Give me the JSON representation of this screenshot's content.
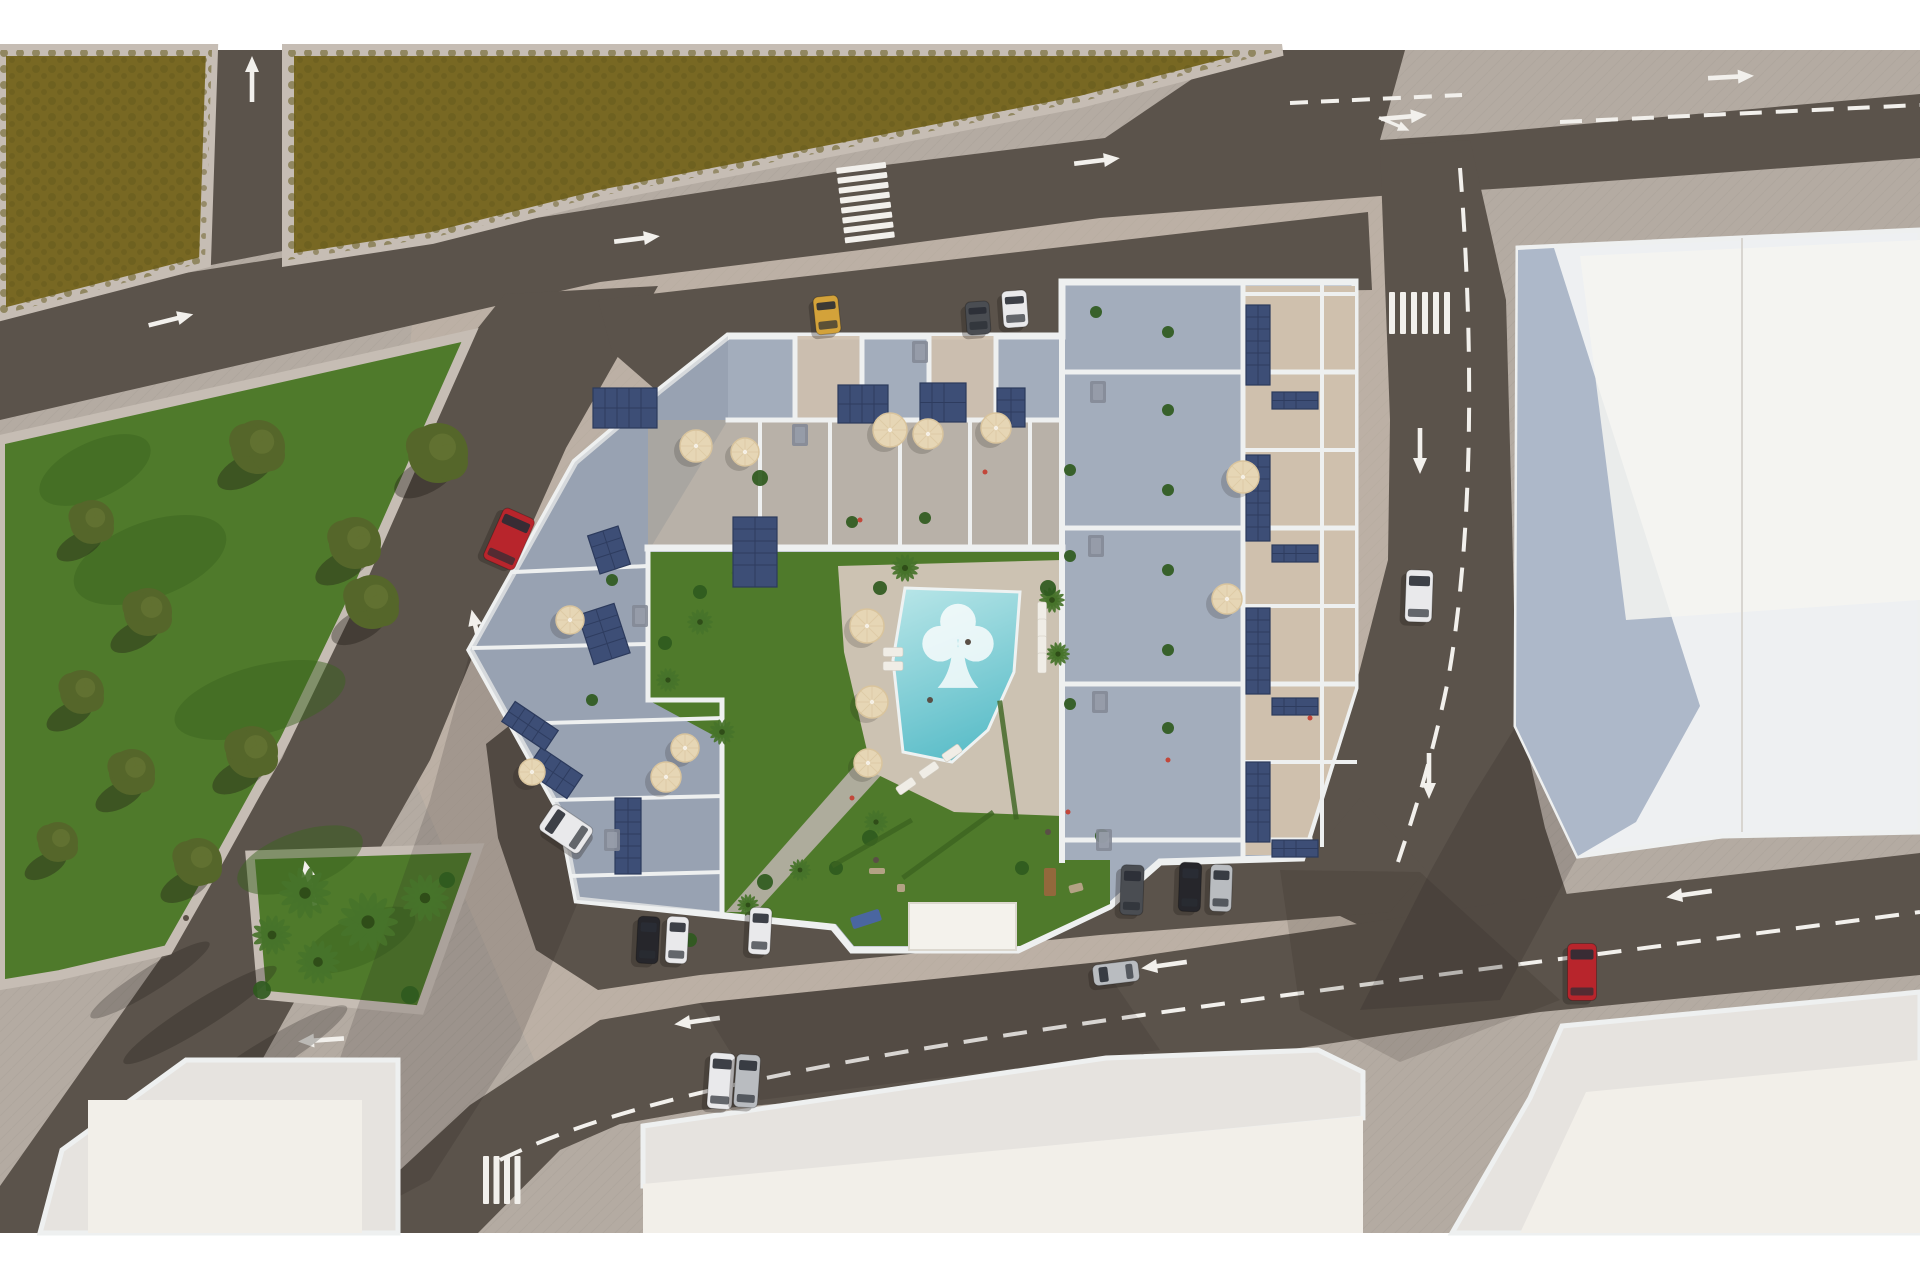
{
  "scene": {
    "description": "aerial-3d-render-residential-complex-with-pool",
    "content_top": 50,
    "content_bottom": 1233
  },
  "colors": {
    "white_margin": "#ffffff",
    "sidewalk": "#b4aba2",
    "sidewalk_light": "#c6bdb4",
    "sidewalk_warm": "#c8b9ab",
    "road": "#5b534b",
    "road_dark": "#4b443e",
    "field": "#786823",
    "field_dark": "#665a1d",
    "grass": "#4f7a2b",
    "grass_dark": "#3c6420",
    "tree": "#55662a",
    "tree_hi": "#6d7c38",
    "palm": "#47732a",
    "palm_core": "#2f4d18",
    "bush": "#2f5a1e",
    "marking": "#f2f0ec",
    "wall": "#eef0f0",
    "terrace": "#a3adbc",
    "terrace_shade": "#6a7383",
    "gravel": "#cfc0ad",
    "path": "#b8b1a8",
    "deck": "#ccc2b2",
    "solar": "#3d4e76",
    "solar_line": "#2c3a5c",
    "umbrella": "#e6d6b5",
    "umbrella_dark": "#d9c49d",
    "pool_light": "#b9e6e8",
    "pool_deep": "#5fbfca",
    "logo": "#ffffff",
    "bldg_roof": "#e6e3df",
    "bldg_face": "#f2efe9",
    "bldg_shadow_face": "#a9b4c6",
    "bldg_white": "#eef0f2",
    "cabana": "#f4f2ec",
    "lounger": "#f0ede6",
    "table": "#848a96",
    "shadow": "#201b16",
    "car_red": "#b8252c",
    "car_white": "#e9e9eb",
    "car_silver": "#b9bcc0",
    "car_black": "#26262b",
    "car_dark": "#4a4d52",
    "car_yellow": "#d3a23a",
    "car_glass": "#2a2e35",
    "play_blue": "#4a66a0",
    "play_wood": "#b3a284",
    "play_wood2": "#93683c",
    "people": "#5a4f46",
    "flower": "#c2473a"
  },
  "trees": [
    [
      258,
      447,
      27
    ],
    [
      438,
      453,
      30
    ],
    [
      92,
      522,
      22
    ],
    [
      355,
      543,
      26
    ],
    [
      372,
      602,
      27
    ],
    [
      148,
      612,
      24
    ],
    [
      82,
      692,
      22
    ],
    [
      252,
      752,
      26
    ],
    [
      132,
      772,
      23
    ],
    [
      58,
      842,
      20
    ],
    [
      198,
      862,
      24
    ]
  ],
  "palms": [
    [
      305,
      893,
      26
    ],
    [
      368,
      922,
      30
    ],
    [
      425,
      898,
      24
    ],
    [
      318,
      962,
      22
    ],
    [
      272,
      935,
      20
    ],
    [
      746,
      573,
      15
    ],
    [
      700,
      622,
      13
    ],
    [
      668,
      680,
      12
    ],
    [
      722,
      732,
      13
    ],
    [
      905,
      568,
      14
    ],
    [
      1052,
      600,
      13
    ],
    [
      1058,
      654,
      12
    ],
    [
      876,
      822,
      12
    ],
    [
      800,
      870,
      11
    ],
    [
      748,
      905,
      11
    ]
  ],
  "bushes": [
    [
      262,
      990,
      9
    ],
    [
      410,
      995,
      9
    ],
    [
      447,
      880,
      8
    ],
    [
      760,
      478,
      8
    ],
    [
      700,
      592,
      7
    ],
    [
      665,
      643,
      7
    ],
    [
      742,
      560,
      8
    ],
    [
      880,
      588,
      7
    ],
    [
      1048,
      588,
      8
    ],
    [
      1070,
      470,
      6
    ],
    [
      1070,
      556,
      6
    ],
    [
      1070,
      704,
      6
    ],
    [
      1096,
      312,
      6
    ],
    [
      925,
      518,
      6
    ],
    [
      852,
      522,
      6
    ],
    [
      1168,
      332,
      6
    ],
    [
      1168,
      410,
      6
    ],
    [
      1168,
      490,
      6
    ],
    [
      1168,
      570,
      6
    ],
    [
      1168,
      650,
      6
    ],
    [
      1168,
      728,
      6
    ],
    [
      870,
      838,
      8
    ],
    [
      765,
      882,
      8
    ],
    [
      690,
      940,
      7
    ],
    [
      592,
      700,
      6
    ],
    [
      602,
      640,
      6
    ],
    [
      612,
      580,
      6
    ],
    [
      836,
      868,
      7
    ],
    [
      1022,
      868,
      7
    ],
    [
      1102,
      836,
      7
    ]
  ],
  "umbrellas": [
    [
      745,
      452,
      14
    ],
    [
      696,
      446,
      16
    ],
    [
      890,
      430,
      17
    ],
    [
      928,
      434,
      15
    ],
    [
      996,
      428,
      15
    ],
    [
      867,
      626,
      17
    ],
    [
      872,
      702,
      16
    ],
    [
      868,
      763,
      14
    ],
    [
      685,
      748,
      14
    ],
    [
      666,
      777,
      15
    ],
    [
      570,
      620,
      14
    ],
    [
      532,
      772,
      13
    ],
    [
      1243,
      477,
      16
    ],
    [
      1227,
      599,
      15
    ]
  ],
  "solar_arrays": [
    [
      593,
      388,
      64,
      40,
      0
    ],
    [
      838,
      385,
      50,
      38,
      0
    ],
    [
      920,
      383,
      46,
      39,
      0
    ],
    [
      997,
      388,
      28,
      39,
      0
    ],
    [
      733,
      517,
      44,
      70,
      0
    ],
    [
      593,
      530,
      32,
      40,
      -18
    ],
    [
      585,
      608,
      38,
      52,
      -18
    ],
    [
      615,
      798,
      26,
      76,
      0
    ],
    [
      540,
      748,
      28,
      50,
      -56
    ],
    [
      518,
      700,
      24,
      52,
      -56
    ],
    [
      1246,
      305,
      24,
      80,
      0
    ],
    [
      1246,
      455,
      24,
      86,
      0
    ],
    [
      1246,
      608,
      24,
      86,
      0
    ],
    [
      1246,
      762,
      24,
      80,
      0
    ],
    [
      1272,
      392,
      46,
      17,
      0
    ],
    [
      1272,
      545,
      46,
      17,
      0
    ],
    [
      1272,
      698,
      46,
      17,
      0
    ],
    [
      1272,
      840,
      46,
      17,
      0
    ]
  ],
  "tables": [
    [
      800,
      435
    ],
    [
      640,
      616
    ],
    [
      612,
      840
    ],
    [
      1098,
      392
    ],
    [
      1096,
      546
    ],
    [
      1100,
      702
    ],
    [
      1104,
      840
    ],
    [
      920,
      352
    ]
  ],
  "loungers": [
    [
      1042,
      612,
      90
    ],
    [
      1042,
      629,
      90
    ],
    [
      1042,
      646,
      90
    ],
    [
      1042,
      663,
      90
    ],
    [
      952,
      753,
      -35
    ],
    [
      929,
      770,
      -35
    ],
    [
      906,
      786,
      -35
    ],
    [
      893,
      652,
      0
    ],
    [
      893,
      666,
      0
    ]
  ],
  "play_items": [
    [
      866,
      919,
      30,
      12,
      "play_blue",
      -18
    ],
    [
      877,
      871,
      16,
      6,
      "play_wood",
      0
    ],
    [
      1050,
      882,
      12,
      28,
      "play_wood2",
      0
    ],
    [
      1076,
      888,
      14,
      8,
      "play_wood",
      -15
    ],
    [
      901,
      888,
      8,
      8,
      "play_wood",
      0
    ]
  ],
  "hedges": [
    [
      872,
      843,
      92,
      5,
      -30
    ],
    [
      948,
      845,
      112,
      5,
      -36
    ],
    [
      1008,
      760,
      5,
      120,
      -8
    ]
  ],
  "grass_patches": [
    [
      150,
      560,
      80,
      38,
      -20
    ],
    [
      260,
      700,
      88,
      34,
      -15
    ],
    [
      95,
      470,
      60,
      28,
      -25
    ],
    [
      300,
      860,
      66,
      28,
      -20
    ],
    [
      360,
      940,
      60,
      24,
      -25
    ]
  ],
  "people": [
    [
      1048,
      832
    ],
    [
      876,
      860
    ],
    [
      930,
      700
    ],
    [
      968,
      642
    ],
    [
      186,
      918
    ]
  ],
  "flowers": [
    [
      852,
      798
    ],
    [
      1068,
      812
    ],
    [
      985,
      472
    ],
    [
      1310,
      718
    ],
    [
      860,
      520
    ],
    [
      1168,
      760
    ]
  ],
  "cars": [
    [
      "red-car-northbound",
      509,
      539,
      34,
      56,
      24,
      "car_red"
    ],
    [
      "white-car-southbound",
      1419,
      596,
      27,
      52,
      2,
      "car_white"
    ],
    [
      "red-car-parked-east",
      1582,
      972,
      29,
      57,
      0,
      "car_red"
    ],
    [
      "yellow-car-parked-north",
      827,
      315,
      25,
      38,
      -6,
      "car_yellow"
    ],
    [
      "gray-car-parked-north",
      978,
      318,
      24,
      33,
      -4,
      "car_dark"
    ],
    [
      "white-car-parked-north",
      1015,
      309,
      25,
      37,
      -4,
      "car_white"
    ],
    [
      "white-van-parked-west",
      566,
      829,
      31,
      48,
      -56,
      "car_white"
    ],
    [
      "black-car-parked-south",
      648,
      940,
      22,
      47,
      3,
      "car_black"
    ],
    [
      "white-car-parked-south",
      677,
      940,
      22,
      47,
      3,
      "car_white"
    ],
    [
      "white-car-parked-south-2",
      760,
      931,
      22,
      47,
      3,
      "car_white"
    ],
    [
      "gray-car-parked-southeast",
      1132,
      890,
      23,
      50,
      2,
      "car_dark"
    ],
    [
      "black-car-parked-southeast",
      1190,
      887,
      22,
      49,
      2,
      "car_black"
    ],
    [
      "silver-car-parked-southeast",
      1221,
      888,
      22,
      47,
      2,
      "car_silver"
    ],
    [
      "silver-car-westbound",
      1116,
      973,
      46,
      21,
      -7,
      "car_silver"
    ],
    [
      "white-car-bottom-road",
      721,
      1081,
      25,
      56,
      4,
      "car_white"
    ],
    [
      "silver-car-bottom-road",
      747,
      1081,
      24,
      53,
      4,
      "car_silver"
    ]
  ],
  "arrows": [
    [
      170,
      320,
      -14,
      "straight"
    ],
    [
      636,
      239,
      -7,
      "straight"
    ],
    [
      1096,
      161,
      -7,
      "straight"
    ],
    [
      252,
      80,
      -90,
      "straight"
    ],
    [
      477,
      633,
      -103,
      "straight"
    ],
    [
      310,
      884,
      -103,
      "straight"
    ],
    [
      1403,
      117,
      -5,
      "fork"
    ],
    [
      1730,
      77,
      -3,
      "straight"
    ],
    [
      1420,
      450,
      90,
      "straight"
    ],
    [
      1429,
      775,
      90,
      "straight"
    ],
    [
      1165,
      965,
      172,
      "straight"
    ],
    [
      1690,
      894,
      172,
      "straight"
    ],
    [
      698,
      1021,
      172,
      "straight"
    ],
    [
      322,
      1040,
      176,
      "straight"
    ]
  ]
}
